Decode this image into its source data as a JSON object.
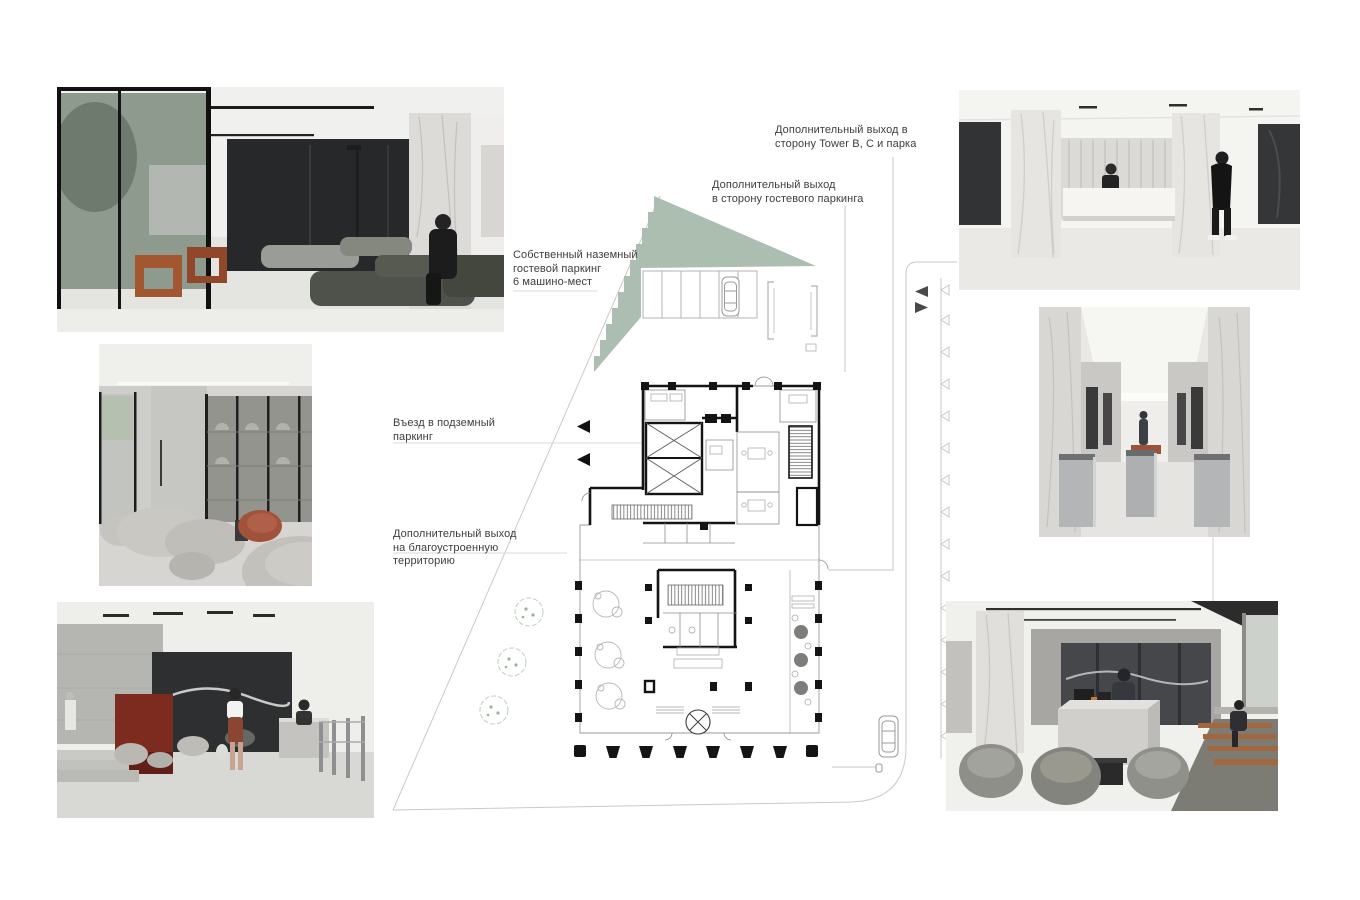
{
  "board": {
    "type": "architectural-presentation",
    "palette": {
      "park_zone_green": "#a6bbac",
      "plan_wall_black": "#141414",
      "site_line_gray": "#c9c9c9",
      "accent_red": "#a2523a",
      "wood_orange": "#9c4f2c",
      "label_text": "#3d3d3d"
    }
  },
  "labels": {
    "exit_tower": {
      "lines": [
        "Дополнительный выход в",
        "сторону Tower B, C и парка"
      ]
    },
    "exit_guest": {
      "lines": [
        "Дополнительный выход",
        "в сторону гостевого паркинга"
      ]
    },
    "parking_own": {
      "lines": [
        "Собственный наземный",
        "гостевой паркинг",
        "6 машино-мест"
      ]
    },
    "entry_underground": {
      "lines": [
        "Въезд в подземный",
        "паркинг"
      ]
    },
    "exit_territory": {
      "lines": [
        "Дополнительный выход",
        "на благоустроенную",
        "территорию"
      ]
    }
  },
  "photos": [
    {
      "id": "lobby-seating",
      "alt": "Lobby render with sofas and orange chairs"
    },
    {
      "id": "lounge-glass",
      "alt": "Lounge render with curved sofas and red chair"
    },
    {
      "id": "entrance-turnstiles",
      "alt": "Lobby render with red wall and turnstiles"
    },
    {
      "id": "reception-white",
      "alt": "White lobby render with marble columns and reception desk"
    },
    {
      "id": "elevator-corridor",
      "alt": "Elevator corridor render with turnstiles"
    },
    {
      "id": "cafe-lounge",
      "alt": "Cafe lounge render with stone counter and wood benches"
    }
  ]
}
